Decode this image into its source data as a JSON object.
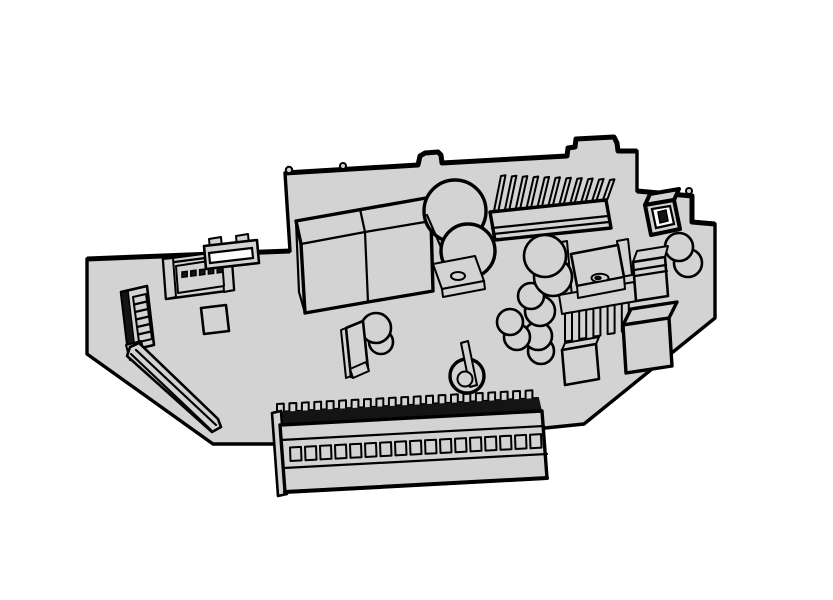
{
  "canvas": {
    "width": 833,
    "height": 600,
    "background": "#ffffff"
  },
  "drawing": {
    "kind": "isometric-technical-line-drawing",
    "subject": "controller-circuit-board-assembly",
    "colors": {
      "background": "#ffffff",
      "surface": "#d3d3d3",
      "outline": "#000000",
      "dark": "#141414",
      "white": "#ffffff"
    },
    "counts": {
      "big_heatsink_fins": 11,
      "terminal_block_holes": 17,
      "terminal_block_teeth": 21,
      "header_pins": 5,
      "ffc_rungs": 5,
      "small_heatsink_teeth": 5
    },
    "components": [
      {
        "id": "pcb-board",
        "label": "circuit board outline"
      },
      {
        "id": "terminal-block",
        "label": "screw terminal block"
      },
      {
        "id": "big-heatsink",
        "label": "finned heatsink"
      },
      {
        "id": "relay-pair",
        "label": "twin relay boxes"
      },
      {
        "id": "big-capacitor",
        "label": "large electrolytic capacitor with bracket"
      },
      {
        "id": "capacitor-cluster",
        "label": "small electrolytic capacitors"
      },
      {
        "id": "to220-heatsink",
        "label": "transistor on small heatsink"
      },
      {
        "id": "jst-connector",
        "label": "two-pin connector"
      },
      {
        "id": "header-connector",
        "label": "multi-pin header connector"
      },
      {
        "id": "edge-connector",
        "label": "small edge connector"
      },
      {
        "id": "ffc-connector",
        "label": "flat-cable connector"
      },
      {
        "id": "board-slot",
        "label": "diagonal slot cutout"
      },
      {
        "id": "film-capacitor",
        "label": "film capacitor box"
      },
      {
        "id": "cube-component",
        "label": "cube component"
      },
      {
        "id": "flat-pad",
        "label": "flat square pad"
      },
      {
        "id": "square-pad",
        "label": "square pad"
      },
      {
        "id": "plate-component",
        "label": "vertical plate component"
      },
      {
        "id": "wire-loop",
        "label": "wire loop component"
      }
    ]
  }
}
